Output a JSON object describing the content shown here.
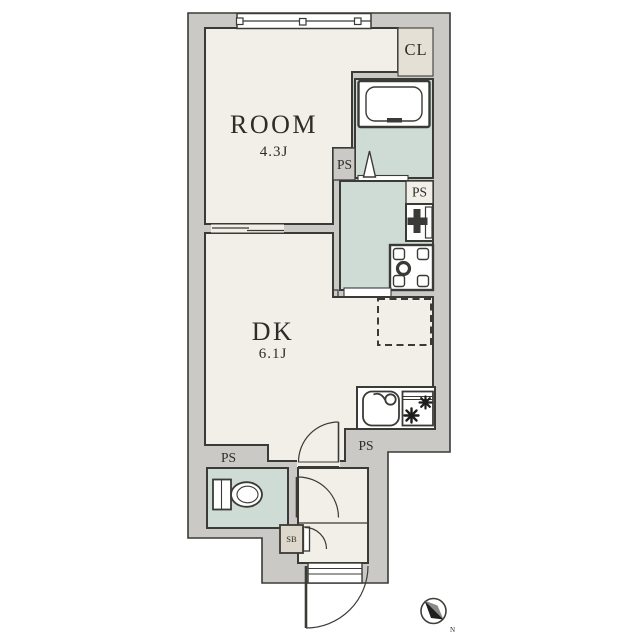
{
  "floorplan": {
    "type": "apartment-floor-plan",
    "labels": {
      "room_name": "ROOM",
      "room_size": "4.3J",
      "dk_name": "DK",
      "dk_size": "6.1J",
      "closet": "CL",
      "ps_bath": "PS",
      "ps_washroom": "PS",
      "ps_kitchen": "PS",
      "ps_toilet": "PS",
      "shoe_box": "SB",
      "compass_north": "N"
    },
    "rooms": [
      {
        "name": "ROOM",
        "size_tatami": "4.3J"
      },
      {
        "name": "DK",
        "size_tatami": "6.1J"
      },
      {
        "name": "CL"
      },
      {
        "name": "bathroom"
      },
      {
        "name": "washroom"
      },
      {
        "name": "toilet"
      },
      {
        "name": "entrance"
      }
    ],
    "fixtures": [
      "bathtub",
      "washbasin",
      "washing-machine-pan",
      "kitchen-sink",
      "gas-stove",
      "refrigerator-space",
      "toilet-bowl",
      "shoe-box",
      "sliding-window",
      "entrance-door"
    ],
    "colors": {
      "wall_fill": "#cac9c6",
      "outline": "#3a3a37",
      "floor": "#f2efe8",
      "wet_floor": "#cfdcd6",
      "closet_floor": "#e4e0d5",
      "shoebox_fill": "#ddd8cb",
      "fixture_fill": "#ffffff",
      "text": "#2d2c29",
      "background": "#ffffff"
    }
  }
}
